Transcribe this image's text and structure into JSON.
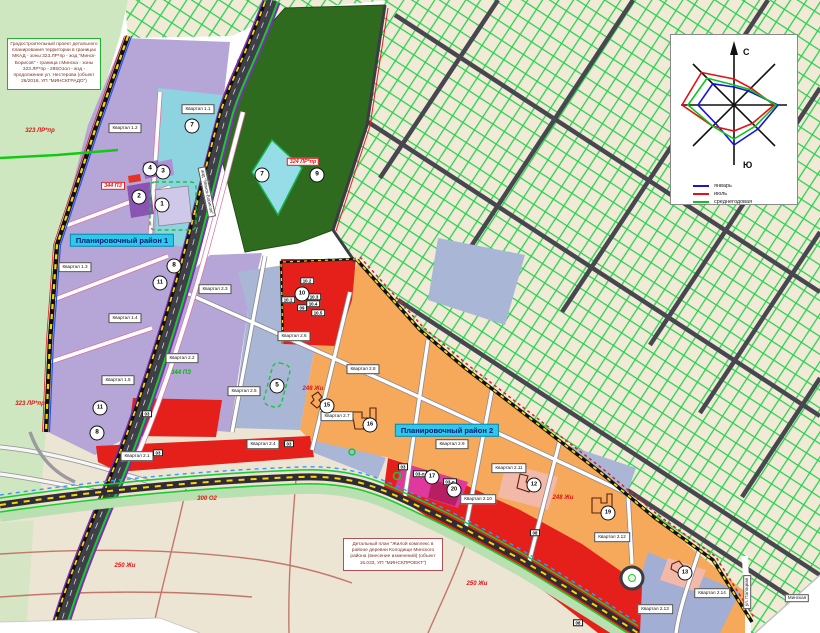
{
  "map": {
    "title_block": "Градостроительный проект детального планирования территории в границах МКАД - зоны 323.ЛР*пр - жзд \"Минск-Борисов\" - граница г.Минска - зоны 323.ЛР*пр - 285О1ол - жзд - продолжение ул. Нестерова (объект 26/2016, УП \"МИНСКГРАДО\")",
    "note_block": "Детальный план \"Жилой комплекс в районе деревни Колодищи Минского района (внесение изменений) (объект 15.033, УП \"МИНСКПРОЕКТ\")",
    "district_labels": [
      {
        "t": "Планировочный район 1",
        "x": 122,
        "y": 240
      },
      {
        "t": "Планировочный район 2",
        "x": 447,
        "y": 430
      }
    ],
    "quarter_labels": [
      {
        "t": "Квартал 1.1",
        "x": 198,
        "y": 109
      },
      {
        "t": "Квартал 1.2",
        "x": 125,
        "y": 128
      },
      {
        "t": "Квартал 1.3",
        "x": 75,
        "y": 267
      },
      {
        "t": "Квартал 1.4",
        "x": 125,
        "y": 318
      },
      {
        "t": "Квартал 1.5",
        "x": 118,
        "y": 380
      },
      {
        "t": "Квартал 2.1",
        "x": 137,
        "y": 456
      },
      {
        "t": "Квартал 2.2",
        "x": 182,
        "y": 358
      },
      {
        "t": "Квартал 2.3",
        "x": 215,
        "y": 289
      },
      {
        "t": "Квартал 2.4",
        "x": 263,
        "y": 444
      },
      {
        "t": "Квартал 2.5",
        "x": 244,
        "y": 391
      },
      {
        "t": "Квартал 2.6",
        "x": 294,
        "y": 336
      },
      {
        "t": "Квартал 2.7",
        "x": 337,
        "y": 416
      },
      {
        "t": "Квартал 2.8",
        "x": 363,
        "y": 369
      },
      {
        "t": "Квартал 2.9",
        "x": 452,
        "y": 444
      },
      {
        "t": "Квартал 2.10",
        "x": 478,
        "y": 499
      },
      {
        "t": "Квартал 2.11",
        "x": 509,
        "y": 468
      },
      {
        "t": "Квартал 2.12",
        "x": 612,
        "y": 537
      },
      {
        "t": "Квартал 2.13",
        "x": 655,
        "y": 609
      },
      {
        "t": "Квартал 2.14",
        "x": 712,
        "y": 593
      }
    ],
    "zone_labels": [
      {
        "t": "323 ЛР*пр",
        "x": 40,
        "y": 131,
        "c": "red"
      },
      {
        "t": "323 ЛР*пр",
        "x": 30,
        "y": 404,
        "c": "red"
      },
      {
        "t": "324 ЛР*пр",
        "x": 303,
        "y": 162,
        "c": "red",
        "boxed": true
      },
      {
        "t": "344 ПЗ",
        "x": 113,
        "y": 186,
        "c": "red",
        "boxed": true
      },
      {
        "t": "344 ПЗ",
        "x": 181,
        "y": 373,
        "c": "green"
      },
      {
        "t": "248 Жи",
        "x": 313,
        "y": 389,
        "c": "red"
      },
      {
        "t": "248 Жи",
        "x": 563,
        "y": 498,
        "c": "red"
      },
      {
        "t": "250 Жи",
        "x": 125,
        "y": 566,
        "c": "red"
      },
      {
        "t": "250 Жи",
        "x": 477,
        "y": 584,
        "c": "red"
      },
      {
        "t": "300 О2",
        "x": 207,
        "y": 499,
        "c": "red"
      }
    ],
    "site_labels": [
      {
        "t": "10.1",
        "x": 288,
        "y": 300
      },
      {
        "t": "10.2",
        "x": 307,
        "y": 281
      },
      {
        "t": "10.3",
        "x": 314,
        "y": 297
      },
      {
        "t": "10.4",
        "x": 313,
        "y": 304
      },
      {
        "t": "10.5",
        "x": 318,
        "y": 313
      },
      {
        "t": "09",
        "x": 302,
        "y": 308
      },
      {
        "t": "03",
        "x": 147,
        "y": 414
      },
      {
        "t": "03",
        "x": 158,
        "y": 453
      },
      {
        "t": "03",
        "x": 289,
        "y": 444
      },
      {
        "t": "03",
        "x": 403,
        "y": 467
      },
      {
        "t": "03-л",
        "x": 420,
        "y": 474
      },
      {
        "t": "03-л",
        "x": 450,
        "y": 482
      },
      {
        "t": "08",
        "x": 535,
        "y": 533
      },
      {
        "t": "08",
        "x": 578,
        "y": 623
      }
    ],
    "markers": [
      {
        "n": "1",
        "x": 162,
        "y": 205
      },
      {
        "n": "2",
        "x": 139,
        "y": 197
      },
      {
        "n": "3",
        "x": 163,
        "y": 172
      },
      {
        "n": "4",
        "x": 150,
        "y": 169
      },
      {
        "n": "5",
        "x": 277,
        "y": 386
      },
      {
        "n": "7",
        "x": 192,
        "y": 126
      },
      {
        "n": "7",
        "x": 262,
        "y": 175
      },
      {
        "n": "8",
        "x": 174,
        "y": 266
      },
      {
        "n": "8",
        "x": 97,
        "y": 433
      },
      {
        "n": "9",
        "x": 317,
        "y": 175
      },
      {
        "n": "10",
        "x": 302,
        "y": 294
      },
      {
        "n": "11",
        "x": 160,
        "y": 283
      },
      {
        "n": "11",
        "x": 100,
        "y": 408
      },
      {
        "n": "12",
        "x": 534,
        "y": 485
      },
      {
        "n": "13",
        "x": 685,
        "y": 573
      },
      {
        "n": "15",
        "x": 327,
        "y": 406
      },
      {
        "n": "16",
        "x": 370,
        "y": 425
      },
      {
        "n": "17",
        "x": 432,
        "y": 477
      },
      {
        "n": "19",
        "x": 608,
        "y": 513
      },
      {
        "n": "20",
        "x": 454,
        "y": 490
      }
    ],
    "street_labels": [
      {
        "t": "жзд \"Минск-Борисов\"",
        "x": 207,
        "y": 192,
        "r": 78
      },
      {
        "t": "ул. Полоцкая",
        "x": 747,
        "y": 592,
        "r": -90
      },
      {
        "t": "Минская",
        "x": 797,
        "y": 598,
        "r": 0
      }
    ],
    "wind_rose": {
      "axis_labels": {
        "north": "С",
        "south": "Ю"
      },
      "directions": [
        "С",
        "СВ",
        "В",
        "ЮВ",
        "Ю",
        "ЮЗ",
        "З",
        "СЗ"
      ],
      "series": [
        {
          "name": "январь",
          "color": "#1515e0",
          "values": [
            18,
            20,
            44,
            34,
            40,
            26,
            36,
            30
          ]
        },
        {
          "name": "июль",
          "color": "#e81010",
          "values": [
            26,
            24,
            40,
            26,
            26,
            30,
            52,
            46
          ]
        },
        {
          "name": "среднегодовая",
          "color": "#0cc41c",
          "values": [
            20,
            22,
            42,
            30,
            34,
            30,
            46,
            38
          ]
        }
      ]
    },
    "colors": {
      "district1_purple": "#b6a6d8",
      "quarter_cyan": "#8ed4e0",
      "forest_green": "#2e6b1e",
      "light_green": "#cfe7c0",
      "slate_parcels": "#a9b6d6",
      "orange_quarters": "#f6a95a",
      "red_zones": "#e51f1a",
      "magenta_zone": "#e0389c",
      "grid_line_green": "#25d24f",
      "boundary_yellow": "#ffd700",
      "district_label_bg": "#2fc7ea"
    }
  }
}
